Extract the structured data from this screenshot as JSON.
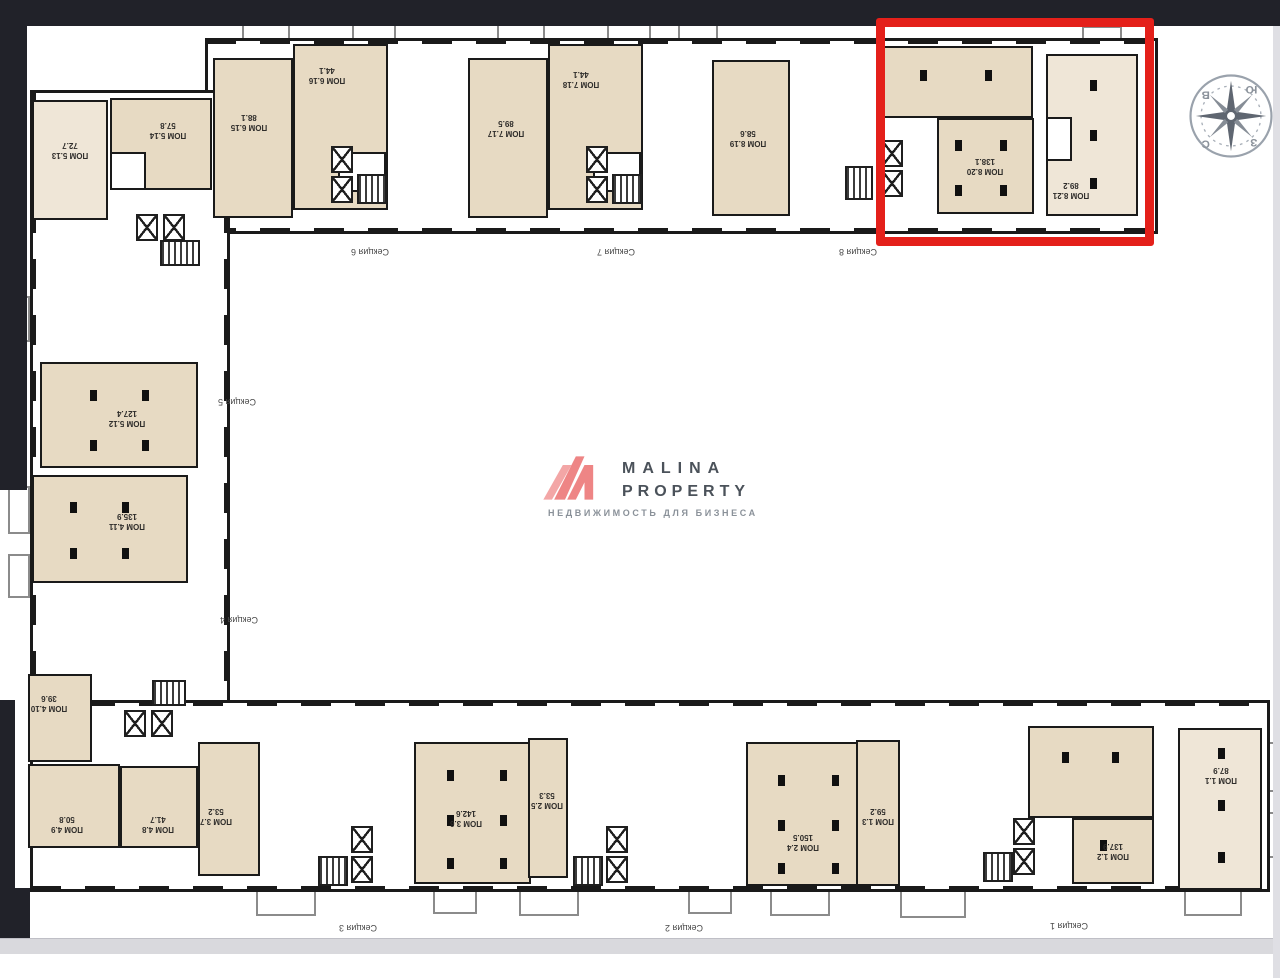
{
  "window": {
    "background": "#ffffff"
  },
  "chrome": {
    "top_bar_color": "#212229",
    "left_bar_color": "#212229",
    "bottom_strip_color": "#d9d9dd",
    "right_strip_color": "#dfdfe4"
  },
  "logo": {
    "name_line1": "MALINA",
    "name_line2": "PROPERTY",
    "tagline": "НЕДВИЖИМОСТЬ ДЛЯ БИЗНЕСА",
    "mark_color": "#ee8585",
    "mark_color_light": "#f3a6a6"
  },
  "compass": {
    "letters": {
      "top_left": "В",
      "top_right": "Ю",
      "bottom_right": "З",
      "bottom_left": "С"
    }
  },
  "highlight": {
    "x": 876,
    "y": 18,
    "w": 278,
    "h": 228,
    "border_color": "#e4201a",
    "border_width": 9,
    "contains": [
      "ПОМ 8.20",
      "ПОМ 8.21"
    ]
  },
  "floorplan": {
    "wall_color": "#1a1a1a",
    "room_fill": "#e7dac3",
    "room_fill_light": "#efe6d7",
    "wings": [
      {
        "dir": "h",
        "rect": [
          205,
          38,
          953,
          196
        ]
      },
      {
        "dir": "v",
        "rect": [
          30,
          90,
          200,
          792
        ]
      },
      {
        "dir": "h",
        "rect": [
          30,
          700,
          1240,
          192
        ]
      }
    ],
    "rooms": [
      {
        "label": "ПОМ 5.13",
        "area": "72.7",
        "rect": [
          32,
          100,
          76,
          120
        ],
        "label_at": [
          70,
          150
        ],
        "light": true
      },
      {
        "label": "ПОМ 5.14",
        "area": "57.8",
        "rect": [
          110,
          98,
          102,
          92
        ],
        "label_at": [
          168,
          130
        ]
      },
      {
        "label": "ПОМ 6.15",
        "area": "88.1",
        "rect": [
          213,
          58,
          80,
          160
        ],
        "label_at": [
          249,
          122
        ]
      },
      {
        "label": "ПОМ 6.16",
        "area": "44.1",
        "rect": [
          293,
          44,
          95,
          166
        ],
        "label_at": [
          327,
          75
        ]
      },
      {
        "label": "ПОМ 7.17",
        "area": "89.5",
        "rect": [
          468,
          58,
          80,
          160
        ],
        "label_at": [
          506,
          128
        ]
      },
      {
        "label": "ПОМ 7.18",
        "area": "44.1",
        "rect": [
          548,
          44,
          95,
          166
        ],
        "label_at": [
          581,
          79
        ]
      },
      {
        "label": "ПОМ 8.19",
        "area": "58.6",
        "rect": [
          712,
          60,
          78,
          156
        ],
        "label_at": [
          748,
          138
        ]
      },
      {
        "label": "",
        "area": "",
        "rect": [
          879,
          46,
          154,
          72
        ]
      },
      {
        "label": "ПОМ 8.20",
        "area": "138.1",
        "rect": [
          937,
          118,
          97,
          96
        ],
        "label_at": [
          985,
          166
        ]
      },
      {
        "label": "ПОМ 8.21",
        "area": "89.2",
        "rect": [
          1046,
          54,
          92,
          162
        ],
        "label_at": [
          1071,
          190
        ],
        "light": true
      },
      {
        "label": "ПОМ 5.12",
        "area": "127.4",
        "rect": [
          40,
          362,
          158,
          106
        ],
        "label_at": [
          127,
          418
        ]
      },
      {
        "label": "ПОМ 4.11",
        "area": "135.9",
        "rect": [
          32,
          475,
          156,
          108
        ],
        "label_at": [
          127,
          521
        ]
      },
      {
        "label": "ПОМ 4.10",
        "area": "39.6",
        "rect": [
          28,
          674,
          64,
          88
        ],
        "label_at": [
          49,
          703
        ]
      },
      {
        "label": "ПОМ 4.9",
        "area": "50.8",
        "rect": [
          28,
          764,
          92,
          84
        ],
        "label_at": [
          67,
          824
        ]
      },
      {
        "label": "ПОМ 4.8",
        "area": "41.7",
        "rect": [
          120,
          766,
          78,
          82
        ],
        "label_at": [
          158,
          824
        ]
      },
      {
        "label": "ПОМ 3.7",
        "area": "53.2",
        "rect": [
          198,
          742,
          62,
          134
        ],
        "label_at": [
          216,
          816
        ]
      },
      {
        "label": "ПОМ 3.6",
        "area": "142.6",
        "rect": [
          414,
          742,
          117,
          142
        ],
        "label_at": [
          466,
          818
        ]
      },
      {
        "label": "ПОМ 2.5",
        "area": "53.3",
        "rect": [
          528,
          738,
          40,
          140
        ],
        "label_at": [
          547,
          800
        ]
      },
      {
        "label": "ПОМ 2.4",
        "area": "150.5",
        "rect": [
          746,
          742,
          115,
          144
        ],
        "label_at": [
          803,
          842
        ]
      },
      {
        "label": "ПОМ 1.3",
        "area": "59.2",
        "rect": [
          856,
          740,
          44,
          146
        ],
        "label_at": [
          878,
          816
        ]
      },
      {
        "label": "",
        "area": "",
        "rect": [
          1028,
          726,
          126,
          92
        ]
      },
      {
        "label": "ПОМ 1.2",
        "area": "137.9",
        "rect": [
          1072,
          818,
          82,
          66
        ],
        "label_at": [
          1113,
          851
        ]
      },
      {
        "label": "ПОМ 1.1",
        "area": "87.9",
        "rect": [
          1178,
          728,
          84,
          162
        ],
        "label_at": [
          1221,
          775
        ],
        "light": true
      }
    ],
    "sections": [
      {
        "label": "Секция 6",
        "at": [
          370,
          252
        ]
      },
      {
        "label": "Секция 7",
        "at": [
          616,
          252
        ]
      },
      {
        "label": "Секция 8",
        "at": [
          858,
          252
        ]
      },
      {
        "label": "Секция 5",
        "at": [
          237,
          402
        ]
      },
      {
        "label": "Секция 4",
        "at": [
          239,
          620
        ]
      },
      {
        "label": "Секция 3",
        "at": [
          358,
          928
        ]
      },
      {
        "label": "Секция 2",
        "at": [
          684,
          928
        ]
      },
      {
        "label": "Секция 1",
        "at": [
          1069,
          926
        ]
      }
    ],
    "elevators": [
      [
        331,
        146
      ],
      [
        331,
        176
      ],
      [
        586,
        146
      ],
      [
        586,
        176
      ],
      [
        881,
        140
      ],
      [
        881,
        170
      ],
      [
        136,
        214
      ],
      [
        163,
        214
      ],
      [
        124,
        710
      ],
      [
        151,
        710
      ],
      [
        351,
        826
      ],
      [
        351,
        856
      ],
      [
        606,
        826
      ],
      [
        606,
        856
      ],
      [
        1013,
        818
      ],
      [
        1013,
        848
      ]
    ],
    "stairs": [
      [
        357,
        174,
        30,
        30
      ],
      [
        612,
        174,
        30,
        30
      ],
      [
        845,
        166,
        28,
        34
      ],
      [
        160,
        240,
        40,
        26
      ],
      [
        152,
        680,
        34,
        26
      ],
      [
        318,
        856,
        30,
        30
      ],
      [
        573,
        856,
        30,
        30
      ],
      [
        983,
        852,
        30,
        30
      ]
    ],
    "porches": [
      [
        242,
        24,
        48,
        16
      ],
      [
        352,
        24,
        44,
        16
      ],
      [
        497,
        24,
        48,
        16
      ],
      [
        607,
        24,
        44,
        16
      ],
      [
        678,
        24,
        40,
        16
      ],
      [
        1082,
        26,
        40,
        14
      ],
      [
        256,
        888,
        60,
        28
      ],
      [
        433,
        888,
        44,
        26
      ],
      [
        519,
        888,
        60,
        28
      ],
      [
        688,
        888,
        44,
        26
      ],
      [
        770,
        888,
        60,
        28
      ],
      [
        900,
        888,
        66,
        30
      ],
      [
        1184,
        888,
        58,
        28
      ],
      [
        8,
        296,
        22,
        46
      ],
      [
        8,
        486,
        22,
        48
      ],
      [
        8,
        554,
        22,
        44
      ],
      [
        1262,
        742,
        14,
        50
      ],
      [
        1262,
        812,
        14,
        46
      ]
    ],
    "holes": [
      [
        338,
        152,
        48,
        40
      ],
      [
        593,
        152,
        48,
        40
      ],
      [
        1046,
        117,
        26,
        44
      ],
      [
        110,
        152,
        36,
        38
      ]
    ],
    "columns": [
      [
        920,
        70
      ],
      [
        985,
        70
      ],
      [
        955,
        140
      ],
      [
        1000,
        140
      ],
      [
        955,
        185
      ],
      [
        1000,
        185
      ],
      [
        1090,
        80
      ],
      [
        1090,
        130
      ],
      [
        1090,
        178
      ],
      [
        447,
        770
      ],
      [
        500,
        770
      ],
      [
        447,
        815
      ],
      [
        500,
        815
      ],
      [
        447,
        858
      ],
      [
        500,
        858
      ],
      [
        778,
        775
      ],
      [
        832,
        775
      ],
      [
        778,
        820
      ],
      [
        832,
        820
      ],
      [
        778,
        863
      ],
      [
        832,
        863
      ],
      [
        1218,
        748
      ],
      [
        1218,
        800
      ],
      [
        1218,
        852
      ],
      [
        1062,
        752
      ],
      [
        1112,
        752
      ],
      [
        1100,
        840
      ],
      [
        90,
        390
      ],
      [
        142,
        390
      ],
      [
        90,
        440
      ],
      [
        142,
        440
      ],
      [
        70,
        502
      ],
      [
        122,
        502
      ],
      [
        70,
        548
      ],
      [
        122,
        548
      ]
    ]
  }
}
